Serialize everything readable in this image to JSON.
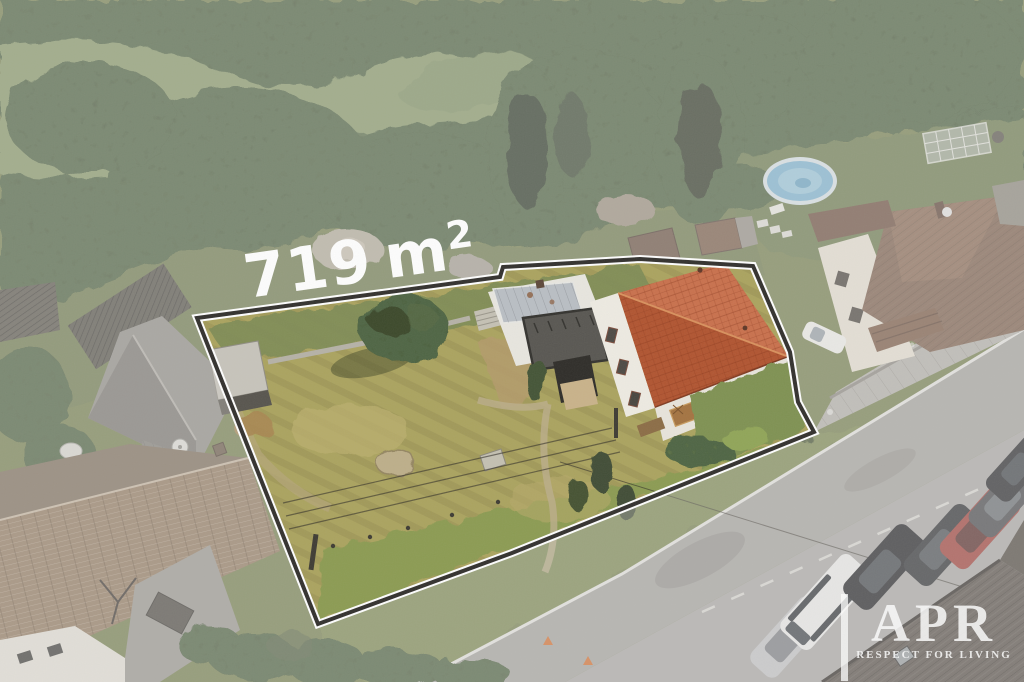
{
  "canvas": {
    "width": 1024,
    "height": 682
  },
  "area_label": {
    "value": "719",
    "unit": "m",
    "superscript": "2",
    "color": "#ffffff"
  },
  "watermark": {
    "brand": "APR",
    "tagline": "RESPECT FOR LIVING",
    "color": "#ffffff"
  },
  "scene": {
    "colors": {
      "forest": "#3d4a33",
      "meadow": "#87996a",
      "field_olive": "#6f7d4f",
      "lawn_dry": "#aaa25c",
      "lawn_green": "#8a9a50",
      "verge_green": "#7d8b52",
      "roof_main": "#c05a33",
      "roof_right_house": "#7d5f4c",
      "roof_left_house": "#947b61",
      "barn_gray": "#92908a",
      "road": "#a8a7a3",
      "road_line": "#eaeae7",
      "sidewalk": "#b7b5af",
      "pool_water": "#7fb8d8",
      "house_wall": "#efece3",
      "terrace": "#55534e",
      "corner_roof": "#57504a",
      "veil": "#d6d4d0",
      "boundary_dark": "#2e2c29",
      "boundary_white": "#ffffff",
      "car_white": "#f1f2f1",
      "car_silver": "#c7c8cb",
      "car_black": "#1d1f24",
      "car_dark": "#2a2c31",
      "car_red": "#a23f39",
      "car_gray": "#46484d",
      "cone_orange": "#d8702e"
    }
  }
}
